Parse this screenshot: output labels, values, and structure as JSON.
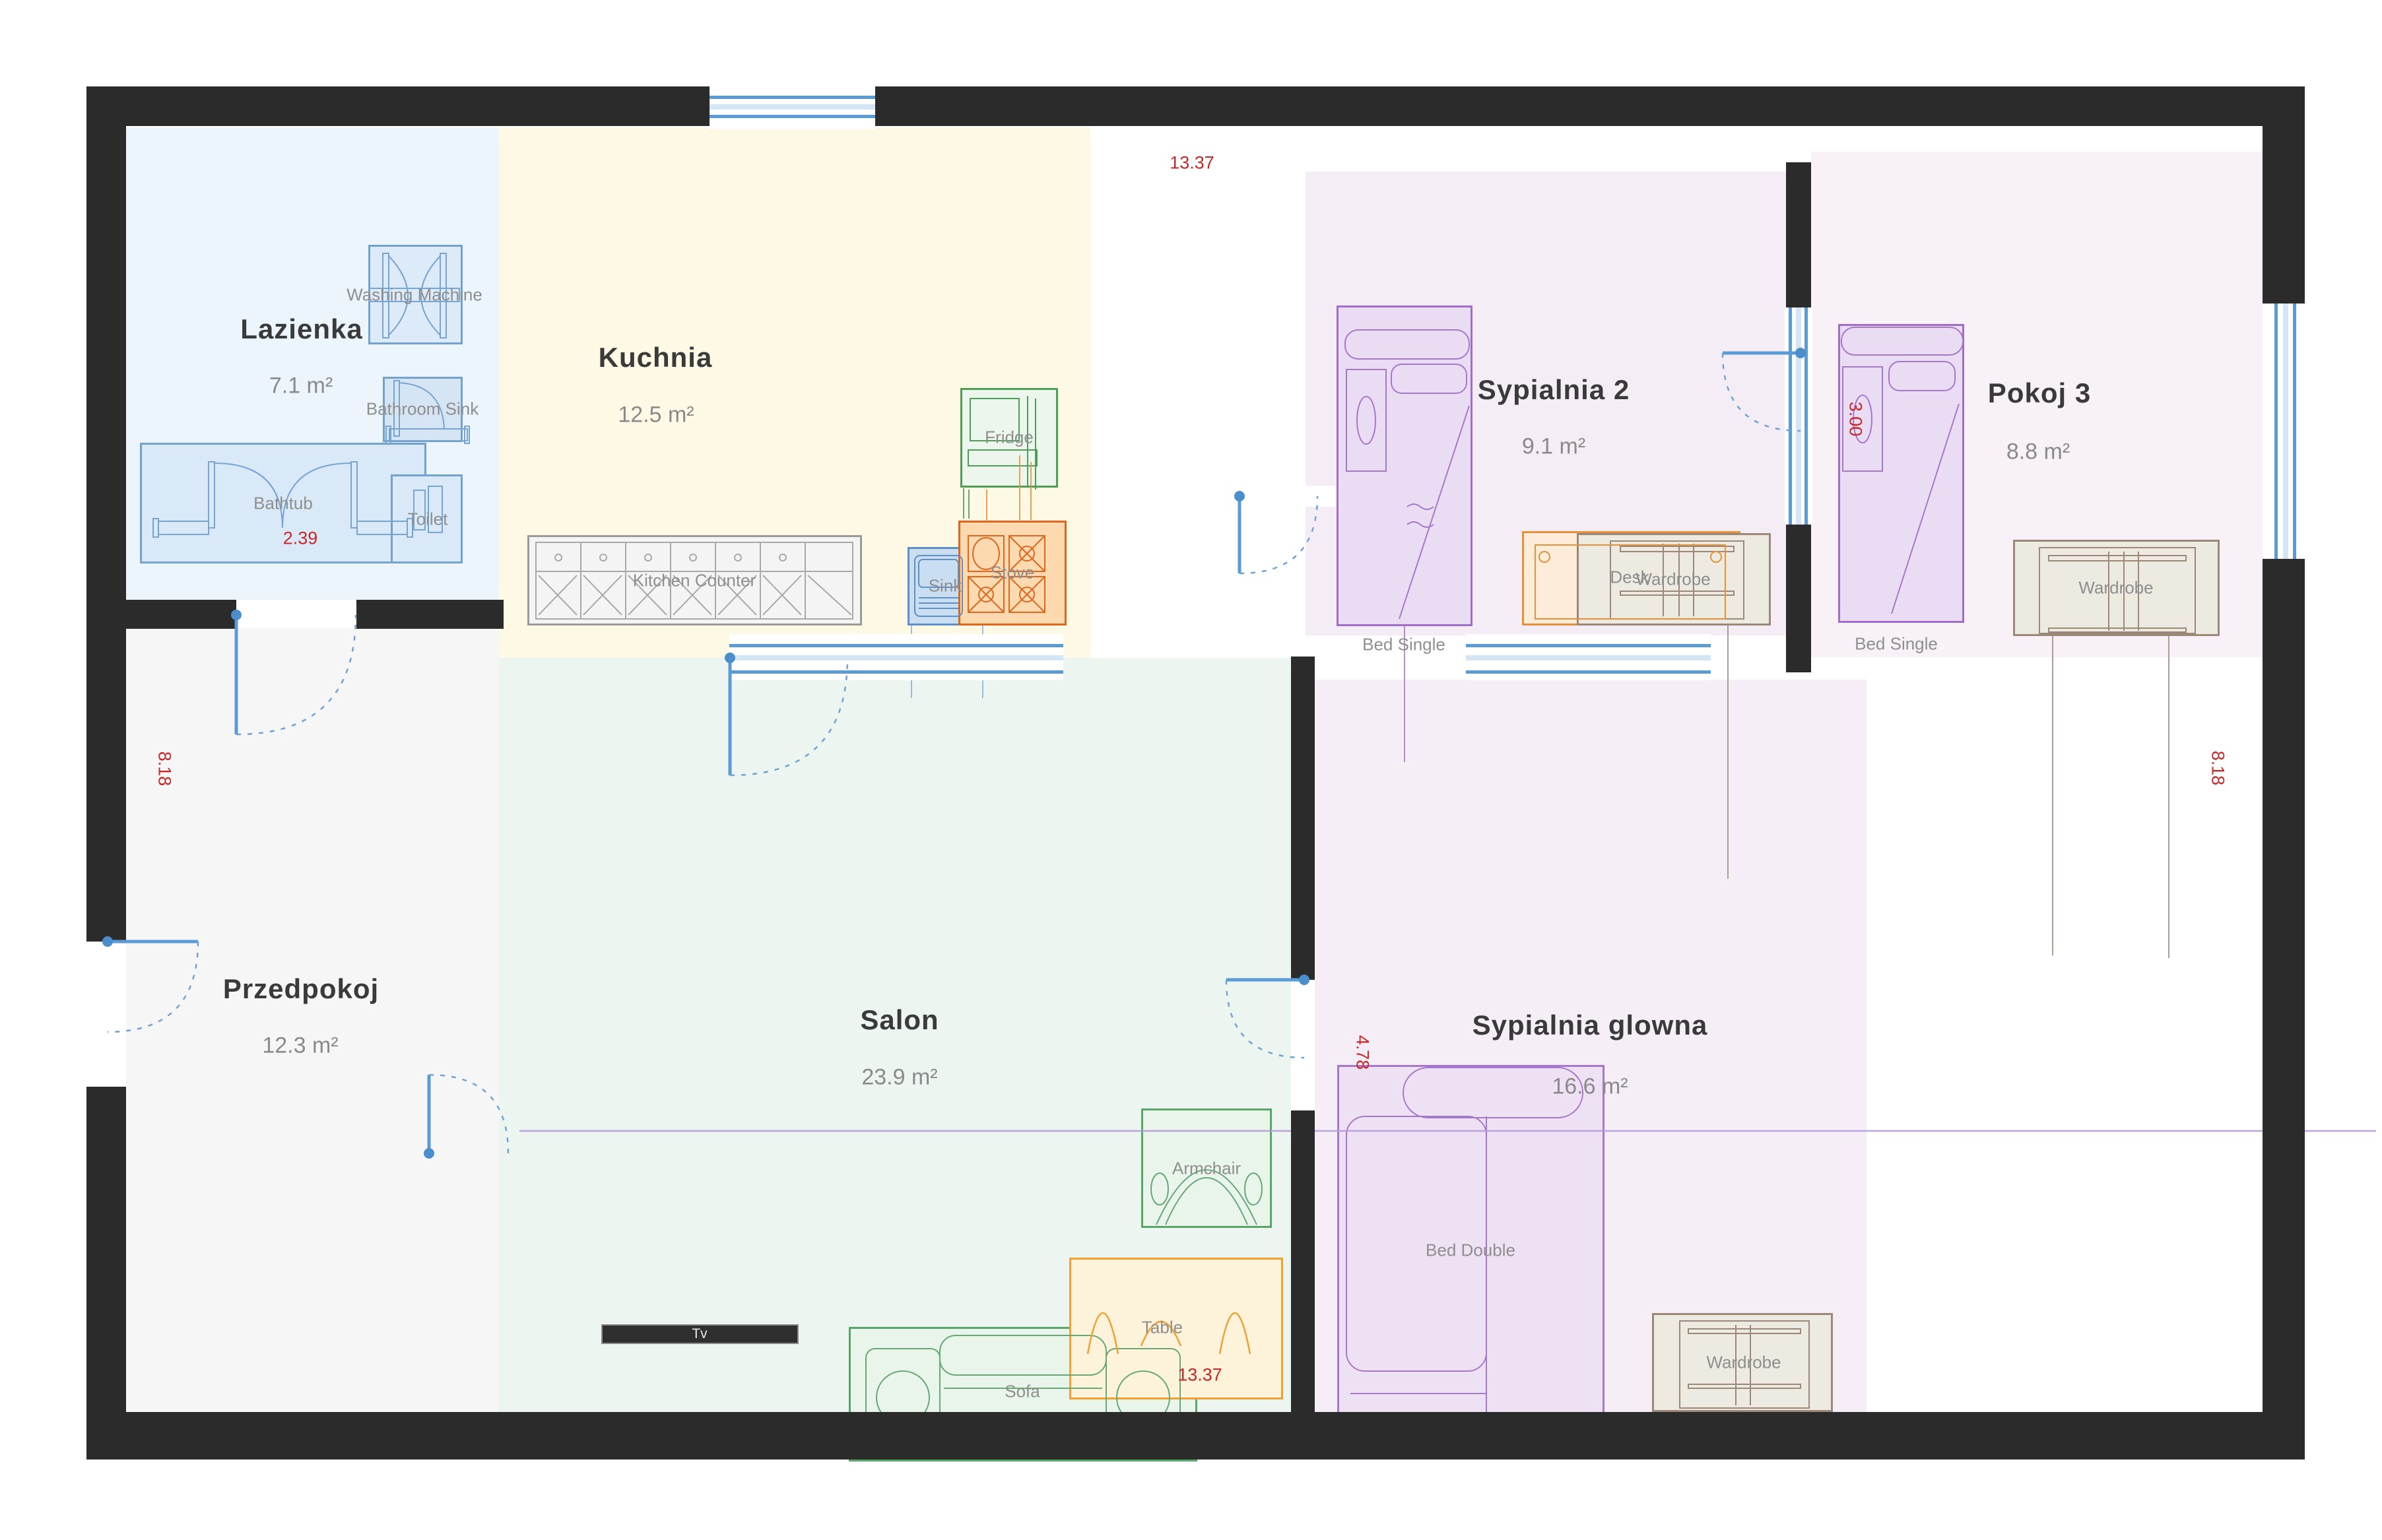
{
  "palette": {
    "wall": "#2b2b2b",
    "window_blue": "#5b9bd5",
    "window_light_blue": "#cfe2f3",
    "door_blue": "#5b9bd5",
    "dimension_red": "#c62828",
    "room_title": "#3a3a3a",
    "room_area": "#8a8a8a",
    "furniture_label": "#8f8f8f",
    "lazienka_fill": "#ebf5fb",
    "kuchnia_fill": "#fdf9e4",
    "salon_fill": "#edf5f0",
    "przedpokoj_fill": "#f6f6f7",
    "sypialnia2_fill": "#f5edf6",
    "pokoj3_fill": "#f8f2f8",
    "sypialnia_glowna_fill": "#f6eef6"
  },
  "rooms": {
    "lazienka": {
      "name": "Lazienka",
      "area": "7.1 m²"
    },
    "kuchnia": {
      "name": "Kuchnia",
      "area": "12.5 m²"
    },
    "sypialnia2": {
      "name": "Sypialnia 2",
      "area": "9.1 m²"
    },
    "pokoj3": {
      "name": "Pokoj 3",
      "area": "8.8 m²"
    },
    "przedpokoj": {
      "name": "Przedpokoj",
      "area": "12.3 m²"
    },
    "salon": {
      "name": "Salon",
      "area": "23.9 m²"
    },
    "sypialnia_glowna": {
      "name": "Sypialnia glowna",
      "area": "16.6 m²"
    }
  },
  "furniture": {
    "washing_machine": "Washing Machine",
    "bathroom_sink": "Bathroom Sink",
    "bathtub": "Bathtub",
    "toilet": "Toilet",
    "kitchen_counter": "Kitchen Counter",
    "sink": "Sink",
    "stove": "Stove",
    "fridge": "Fridge",
    "tv": "Tv",
    "sofa": "Sofa",
    "table": "Table",
    "armchair": "Armchair",
    "bed_single": "Bed Single",
    "desk": "Desk",
    "wardrobe": "Wardrobe",
    "bed_double": "Bed Double"
  },
  "dimensions": {
    "top_width": "13.37",
    "bottom_width": "13.37",
    "left_height": "8.18",
    "right_height": "8.18",
    "bathtub_width": "2.39",
    "pokoj3_bed": "3.00",
    "sypialnia_glowna_width": "4.78"
  }
}
